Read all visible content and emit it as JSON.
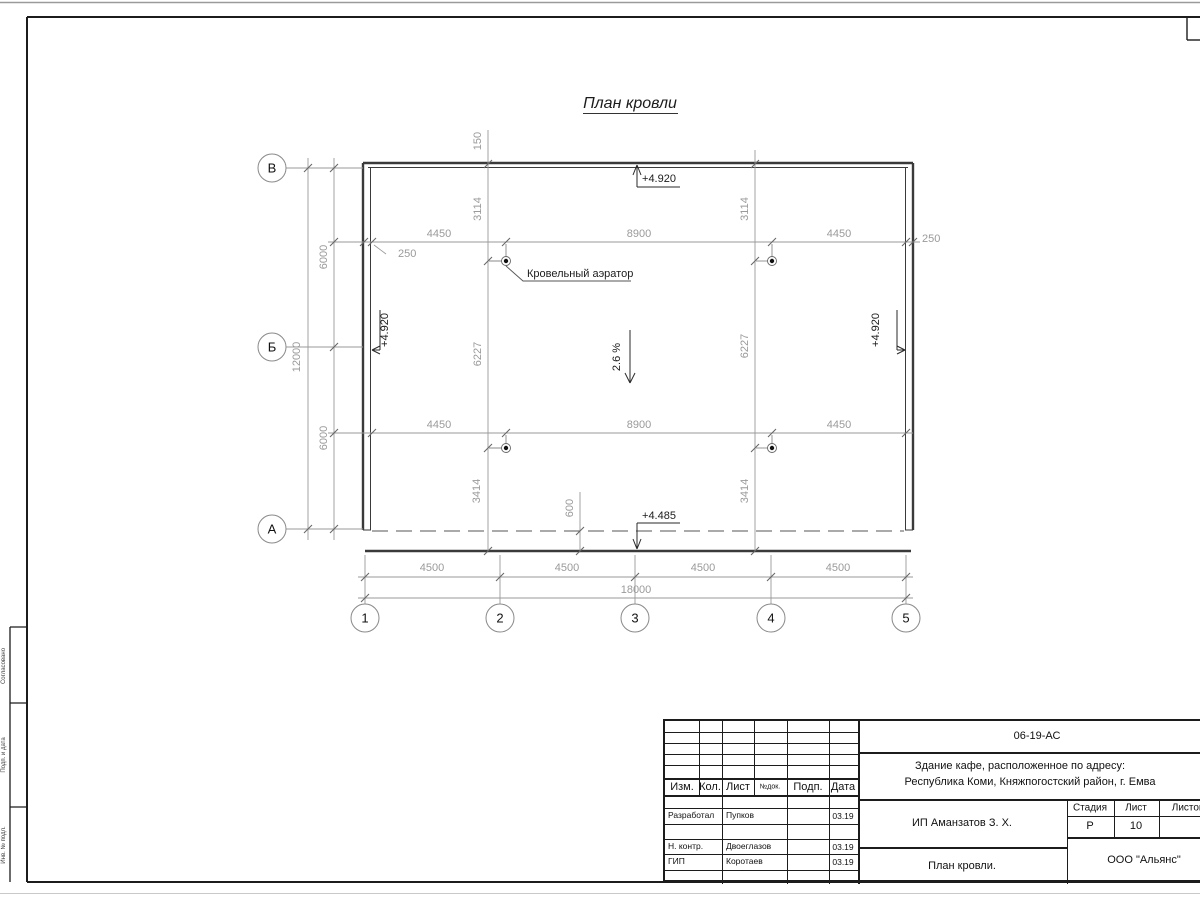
{
  "plan": {
    "title": "План кровли",
    "slope": "2.6 %",
    "aerator_label": "Кровельный аэратор",
    "elevations": {
      "top": "+4.920",
      "left": "+4.920",
      "right": "+4.920",
      "bottom": "+4.485"
    },
    "dims": {
      "row_top": [
        "4450",
        "8900",
        "4450"
      ],
      "row_bottom": [
        "4450",
        "8900",
        "4450"
      ],
      "offset_left": "250",
      "offset_right": "250",
      "parapet": "150",
      "col_left": [
        "3114",
        "6227",
        "3414"
      ],
      "col_right": [
        "3114",
        "6227",
        "3414"
      ],
      "eave": "600",
      "left_spans": [
        "6000",
        "6000"
      ],
      "left_total": "12000",
      "bottom_spans": [
        "4500",
        "4500",
        "4500",
        "4500"
      ],
      "bottom_total": "18000"
    },
    "axes_rows": [
      "В",
      "Б",
      "А"
    ],
    "axes_cols": [
      "1",
      "2",
      "3",
      "4",
      "5"
    ]
  },
  "side_stamp": {
    "labels": [
      "Согласовано",
      "Подп. и дата",
      "Инв. № подл."
    ]
  },
  "title_block": {
    "doc_code": "06-19-АС",
    "project_line1": "Здание кафе, расположенное по адресу:",
    "project_line2": "Республика Коми, Княжпогостский район, г. Емва",
    "client": "ИП Аманзатов З. Х.",
    "sheet_title": "План кровли.",
    "company": "ООО \"Альянс\"",
    "header_cols": [
      "Изм.",
      "Кол.",
      "Лист",
      "№док.",
      "Подп.",
      "Дата"
    ],
    "stage_header": [
      "Стадия",
      "Лист",
      "Листов"
    ],
    "stage": "Р",
    "sheet_no": "10",
    "sheets_total": "",
    "rows": [
      {
        "role": "Разработал",
        "name": "Пупков",
        "date": "03.19"
      },
      {
        "role": "Н. контр.",
        "name": "Двоеглазов",
        "date": "03.19"
      },
      {
        "role": "ГИП",
        "name": "Коротаев",
        "date": "03.19"
      }
    ]
  }
}
